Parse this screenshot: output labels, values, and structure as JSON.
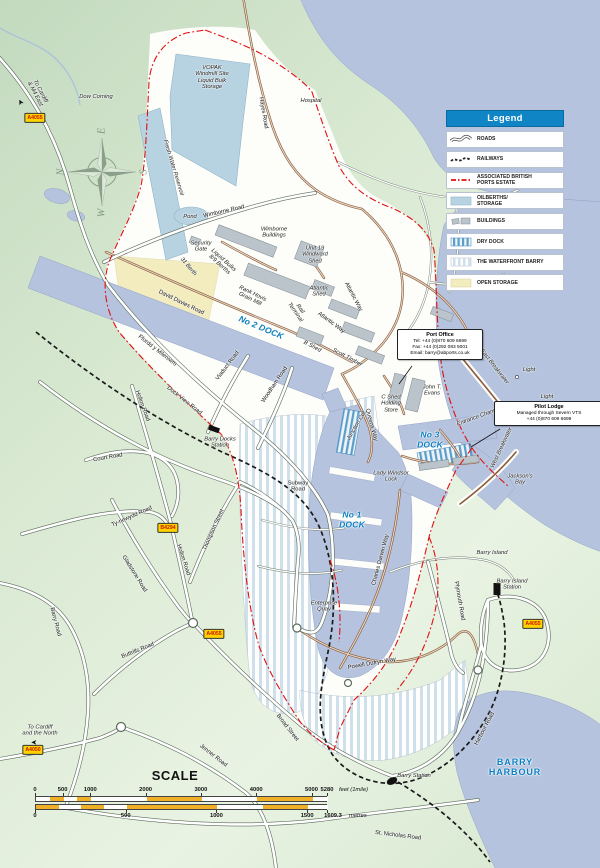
{
  "legend": {
    "title": "Legend",
    "items": [
      {
        "label": "ROADS",
        "swatch": "road"
      },
      {
        "label": "RAILWAYS",
        "swatch": "railway"
      },
      {
        "label": "ASSOCIATED BRITISH\nPORTS ESTATE",
        "swatch": "estate"
      },
      {
        "label": "OILBERTHS/\nSTORAGE",
        "swatch": "storage"
      },
      {
        "label": "BUILDINGS",
        "swatch": "buildings"
      },
      {
        "label": "DRY DOCK",
        "swatch": "drydock"
      },
      {
        "label": "THE WATERFRONT BARRY",
        "swatch": "waterfront"
      },
      {
        "label": "OPEN STORAGE",
        "swatch": "openstorage"
      }
    ]
  },
  "callouts": {
    "port_office": {
      "title": "Port Office",
      "lines": [
        "Tel: +44 (0)870 609 6699",
        "Fax: +44 (0)292 083 5001",
        "Email: barry@abports.co.uk"
      ]
    },
    "pilot_lodge": {
      "title": "Pilot Lodge",
      "lines": [
        "Managed through Severn VTS",
        "+44 (0)870 609 6699"
      ]
    }
  },
  "scale": {
    "title": "SCALE",
    "feet_ticks": [
      0,
      500,
      1000,
      2000,
      3000,
      4000,
      5000
    ],
    "feet_end": 5280,
    "feet_end_label": "5280",
    "feet_suffix": "feet (1mile)",
    "feet_segments": [
      0,
      250,
      500,
      750,
      1000,
      2000,
      3000,
      4000,
      5000,
      5280
    ],
    "metre_ticks": [
      0,
      500,
      1000,
      1500
    ],
    "metre_end": 1609.3,
    "metre_end_label": "1609.3",
    "metre_suffix": "metres",
    "metre_segments": [
      0,
      125,
      250,
      375,
      500,
      1000,
      1250,
      1500,
      1609.3
    ]
  },
  "badges": [
    {
      "text": "A4055",
      "x": 35,
      "y": 118
    },
    {
      "text": "B4294",
      "x": 168,
      "y": 528
    },
    {
      "text": "A4055",
      "x": 214,
      "y": 634
    },
    {
      "text": "A4050",
      "x": 33,
      "y": 750
    },
    {
      "text": "A4055",
      "x": 533,
      "y": 624
    }
  ],
  "colors": {
    "water": "#b5c3de",
    "land_green": "#d9e9d2",
    "estate_white": "#fdfdfa",
    "dock_label_blue": "#0b7ec2",
    "legend_header_blue": "#1085c5",
    "abp_boundary_red": "#e01010",
    "open_storage_yellow": "#f2ecbe",
    "oilberth_blue": "#b7d3e2",
    "scale_yellow": "#efb028",
    "road_badge_yellow": "#ffd200"
  },
  "labels": [
    {
      "t": "Dow Corning",
      "x": 96,
      "y": 97,
      "r": 0,
      "c": "place"
    },
    {
      "t": "To Cardiff\n& M4 East",
      "x": 37,
      "y": 93,
      "r": 62,
      "c": "place"
    },
    {
      "t": "➤",
      "x": 21,
      "y": 102,
      "r": -118,
      "c": "arrow"
    },
    {
      "t": "Hospital",
      "x": 311,
      "y": 101,
      "r": 0,
      "c": "place"
    },
    {
      "t": "VOPAK\nWindmill Site\nLiquid Bulk\nStorage",
      "x": 212,
      "y": 78,
      "r": 0,
      "c": "place"
    },
    {
      "t": "Hayes Road",
      "x": 263,
      "y": 113,
      "r": 80,
      "c": "road"
    },
    {
      "t": "Fresh Water Reservoir",
      "x": 173,
      "y": 168,
      "r": 73,
      "c": "place"
    },
    {
      "t": "Pond",
      "x": 190,
      "y": 217,
      "r": 0,
      "c": "place"
    },
    {
      "t": "N",
      "x": 61,
      "y": 172,
      "r": -90,
      "c": "compass"
    },
    {
      "t": "E",
      "x": 102,
      "y": 131,
      "r": -90,
      "c": "compass"
    },
    {
      "t": "S",
      "x": 144,
      "y": 172,
      "r": -90,
      "c": "compass"
    },
    {
      "t": "W",
      "x": 102,
      "y": 213,
      "r": -90,
      "c": "compass"
    },
    {
      "t": "Wimborne Road",
      "x": 224,
      "y": 212,
      "r": -13,
      "c": "road"
    },
    {
      "t": "Wimborne\nBuildings",
      "x": 274,
      "y": 233,
      "r": 0,
      "c": "place"
    },
    {
      "t": "Security\nGate",
      "x": 201,
      "y": 247,
      "r": 0,
      "c": "place"
    },
    {
      "t": "Unit 19\nWindward\nShed",
      "x": 315,
      "y": 255,
      "r": 0,
      "c": "place"
    },
    {
      "t": "31 Berth",
      "x": 188,
      "y": 267,
      "r": 50,
      "c": "place"
    },
    {
      "t": "Liquid Bulks\n8/9 Berths",
      "x": 221,
      "y": 263,
      "r": 42,
      "c": "place"
    },
    {
      "t": "David Davies Road",
      "x": 181,
      "y": 303,
      "r": 26,
      "c": "road"
    },
    {
      "t": "Rank Hovis\nGrain Mill",
      "x": 251,
      "y": 297,
      "r": 26,
      "c": "place"
    },
    {
      "t": "Atlantic\nShed",
      "x": 319,
      "y": 292,
      "r": 0,
      "c": "place"
    },
    {
      "t": "Atlantic Way",
      "x": 353,
      "y": 297,
      "r": 62,
      "c": "road"
    },
    {
      "t": "Atlantic Way",
      "x": 331,
      "y": 323,
      "r": 36,
      "c": "road"
    },
    {
      "t": "Rail\nTerminal",
      "x": 297,
      "y": 311,
      "r": 55,
      "c": "place"
    },
    {
      "t": "No 2 DOCK",
      "x": 261,
      "y": 328,
      "r": 23,
      "c": "dock"
    },
    {
      "t": "B Shed",
      "x": 312,
      "y": 347,
      "r": 28,
      "c": "place"
    },
    {
      "t": "Scott Timber",
      "x": 347,
      "y": 358,
      "r": 28,
      "c": "place"
    },
    {
      "t": "Ffordd y Mileniwm",
      "x": 157,
      "y": 351,
      "r": 38,
      "c": "road"
    },
    {
      "t": "Viaduct Road",
      "x": 228,
      "y": 366,
      "r": -53,
      "c": "road"
    },
    {
      "t": "Woodham Road",
      "x": 275,
      "y": 385,
      "r": -56,
      "c": "road"
    },
    {
      "t": "Dock View Road",
      "x": 184,
      "y": 401,
      "r": 38,
      "c": "road"
    },
    {
      "t": "Holton Road",
      "x": 142,
      "y": 406,
      "r": 70,
      "c": "road"
    },
    {
      "t": "C Shed\nHolding\nStore",
      "x": 391,
      "y": 404,
      "r": 0,
      "c": "place"
    },
    {
      "t": "John T.\nEvans",
      "x": 432,
      "y": 391,
      "r": 0,
      "c": "place"
    },
    {
      "t": "Queens Way",
      "x": 371,
      "y": 425,
      "r": 75,
      "c": "road"
    },
    {
      "t": "Junction Cut",
      "x": 357,
      "y": 426,
      "r": -60,
      "c": "place"
    },
    {
      "t": "East Breakwater",
      "x": 494,
      "y": 367,
      "r": 52,
      "c": "place"
    },
    {
      "t": "Light",
      "x": 529,
      "y": 370,
      "r": 0,
      "c": "place"
    },
    {
      "t": "Light",
      "x": 547,
      "y": 397,
      "r": 0,
      "c": "place"
    },
    {
      "t": "Entrance Channel",
      "x": 479,
      "y": 417,
      "r": -20,
      "c": "place"
    },
    {
      "t": "West Breakwater",
      "x": 502,
      "y": 448,
      "r": -65,
      "c": "place"
    },
    {
      "t": "Jackson's\nBay",
      "x": 520,
      "y": 480,
      "r": 0,
      "c": "place"
    },
    {
      "t": "No 3\nDOCK",
      "x": 430,
      "y": 440,
      "r": 0,
      "c": "dock"
    },
    {
      "t": "Lady Windsor\nLock",
      "x": 391,
      "y": 477,
      "r": 0,
      "c": "place"
    },
    {
      "t": "No 1\nDOCK",
      "x": 352,
      "y": 520,
      "r": 0,
      "c": "dock"
    },
    {
      "t": "Barry Docks\nStation",
      "x": 220,
      "y": 443,
      "r": 0,
      "c": "place"
    },
    {
      "t": "Subway\nRoad",
      "x": 298,
      "y": 487,
      "r": 0,
      "c": "road"
    },
    {
      "t": "Thompson Street",
      "x": 214,
      "y": 530,
      "r": -66,
      "c": "road"
    },
    {
      "t": "Court Road",
      "x": 108,
      "y": 458,
      "r": -10,
      "c": "road"
    },
    {
      "t": "Ty-newydd Road",
      "x": 132,
      "y": 517,
      "r": -24,
      "c": "road"
    },
    {
      "t": "Holton Road",
      "x": 183,
      "y": 560,
      "r": 72,
      "c": "road"
    },
    {
      "t": "Gladstone Road",
      "x": 134,
      "y": 574,
      "r": 58,
      "c": "road"
    },
    {
      "t": "Barry Road",
      "x": 55,
      "y": 622,
      "r": 75,
      "c": "road"
    },
    {
      "t": "Buttrills Road",
      "x": 138,
      "y": 651,
      "r": -22,
      "c": "road"
    },
    {
      "t": "Charles Darwin Way",
      "x": 381,
      "y": 560,
      "r": -75,
      "c": "road"
    },
    {
      "t": "Barry Island",
      "x": 492,
      "y": 553,
      "r": 0,
      "c": "place"
    },
    {
      "t": "Enterprise\nQuay",
      "x": 324,
      "y": 607,
      "r": 0,
      "c": "place"
    },
    {
      "t": "Plymouth Road",
      "x": 459,
      "y": 601,
      "r": 80,
      "c": "road"
    },
    {
      "t": "Barry Island\nStation",
      "x": 512,
      "y": 585,
      "r": 0,
      "c": "place"
    },
    {
      "t": "Powell Dufryn Way",
      "x": 372,
      "y": 664,
      "r": -10,
      "c": "road"
    },
    {
      "t": "Jenner Road",
      "x": 213,
      "y": 756,
      "r": 38,
      "c": "road"
    },
    {
      "t": "Broad Street",
      "x": 287,
      "y": 728,
      "r": 52,
      "c": "road"
    },
    {
      "t": "To Cardiff\nand the North",
      "x": 40,
      "y": 731,
      "r": 0,
      "c": "place"
    },
    {
      "t": "➤",
      "x": 34,
      "y": 742,
      "r": 180,
      "c": "arrow"
    },
    {
      "t": "Barry Station",
      "x": 414,
      "y": 776,
      "r": 0,
      "c": "place"
    },
    {
      "t": "Harbour Road",
      "x": 485,
      "y": 729,
      "r": -62,
      "c": "road"
    },
    {
      "t": "BARRY\nHARBOUR",
      "x": 515,
      "y": 767,
      "r": 0,
      "c": "harbour"
    },
    {
      "t": "St. Nicholas Road",
      "x": 398,
      "y": 836,
      "r": 7,
      "c": "road"
    }
  ]
}
